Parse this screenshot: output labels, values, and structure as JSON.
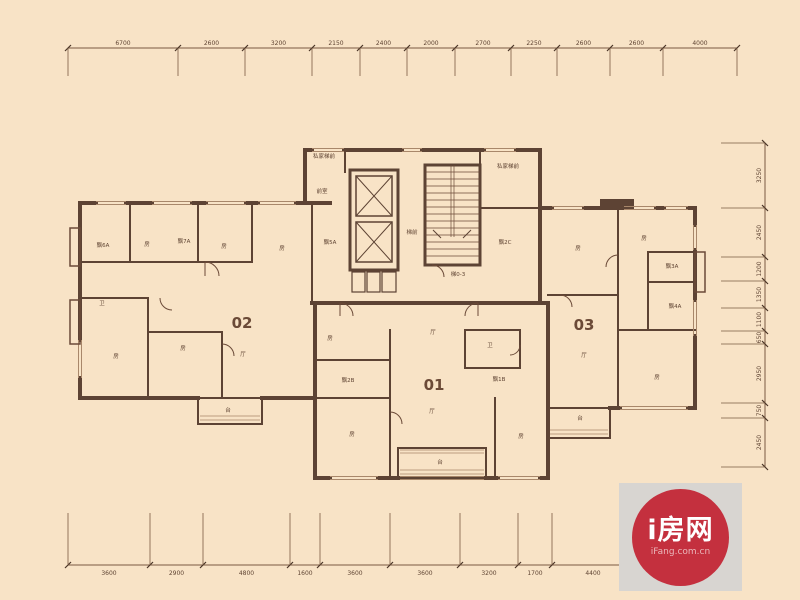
{
  "colors": {
    "background": "#f8e3c6",
    "wall": "#5d4334",
    "thin_line": "#7a5a42",
    "text": "#5f4433",
    "watermark_red": "#c4303e",
    "watermark_gray": "#d8d5d1"
  },
  "watermark": {
    "brand": "i房网",
    "domain": "iFang.com.cn"
  },
  "annotations": {
    "unit_numbers": [
      {
        "text": "02",
        "x": 242,
        "y": 328
      },
      {
        "text": "01",
        "x": 434,
        "y": 390
      },
      {
        "text": "03",
        "x": 584,
        "y": 330
      }
    ],
    "room_labels": [
      {
        "text": "飘6A",
        "x": 103,
        "y": 247
      },
      {
        "text": "房",
        "x": 147,
        "y": 246
      },
      {
        "text": "飘7A",
        "x": 184,
        "y": 243
      },
      {
        "text": "房",
        "x": 224,
        "y": 248
      },
      {
        "text": "房",
        "x": 282,
        "y": 250
      },
      {
        "text": "卫",
        "x": 102,
        "y": 305
      },
      {
        "text": "房",
        "x": 116,
        "y": 358
      },
      {
        "text": "房",
        "x": 183,
        "y": 350
      },
      {
        "text": "厅",
        "x": 243,
        "y": 356
      },
      {
        "text": "台",
        "x": 228,
        "y": 412
      },
      {
        "text": "私家梯前",
        "x": 324,
        "y": 158
      },
      {
        "text": "前室",
        "x": 322,
        "y": 193
      },
      {
        "text": "飘5A",
        "x": 330,
        "y": 244
      },
      {
        "text": "梯前",
        "x": 412,
        "y": 234
      },
      {
        "text": "梯0-3",
        "x": 458,
        "y": 276
      },
      {
        "text": "私家梯前",
        "x": 508,
        "y": 168
      },
      {
        "text": "飘2C",
        "x": 505,
        "y": 244
      },
      {
        "text": "房",
        "x": 330,
        "y": 340
      },
      {
        "text": "厅",
        "x": 433,
        "y": 334
      },
      {
        "text": "卫",
        "x": 490,
        "y": 347
      },
      {
        "text": "飘2B",
        "x": 348,
        "y": 382
      },
      {
        "text": "飘1B",
        "x": 499,
        "y": 381
      },
      {
        "text": "房",
        "x": 352,
        "y": 436
      },
      {
        "text": "厅",
        "x": 432,
        "y": 413
      },
      {
        "text": "房",
        "x": 521,
        "y": 438
      },
      {
        "text": "台",
        "x": 440,
        "y": 464
      },
      {
        "text": "房",
        "x": 578,
        "y": 250
      },
      {
        "text": "房",
        "x": 644,
        "y": 240
      },
      {
        "text": "飘3A",
        "x": 672,
        "y": 268
      },
      {
        "text": "飘4A",
        "x": 675,
        "y": 308
      },
      {
        "text": "厅",
        "x": 584,
        "y": 357
      },
      {
        "text": "房",
        "x": 657,
        "y": 379
      },
      {
        "text": "台",
        "x": 580,
        "y": 420
      }
    ]
  },
  "dimensions": {
    "top": {
      "y": 48,
      "ticks": [
        68,
        178,
        245,
        312,
        360,
        407,
        455,
        511,
        557,
        610,
        663,
        737
      ],
      "labels": [
        "6700",
        "2600",
        "3200",
        "2150",
        "2400",
        "2000",
        "2700",
        "2250",
        "2600",
        "2600",
        "4000"
      ]
    },
    "bottom": {
      "y": 565,
      "ticks": [
        68,
        150,
        203,
        290,
        320,
        390,
        460,
        518,
        552,
        634
      ],
      "labels": [
        "3600",
        "2900",
        "4800",
        "1600",
        "3600",
        "3600",
        "3200",
        "1700",
        "4400"
      ]
    },
    "right": {
      "x": 765,
      "ticks": [
        143,
        208,
        257,
        281,
        308,
        331,
        344,
        403,
        418,
        467
      ],
      "labels": [
        "3250",
        "2450",
        "1200",
        "1350",
        "1100",
        "650",
        "2950",
        "750",
        "2450"
      ]
    }
  }
}
